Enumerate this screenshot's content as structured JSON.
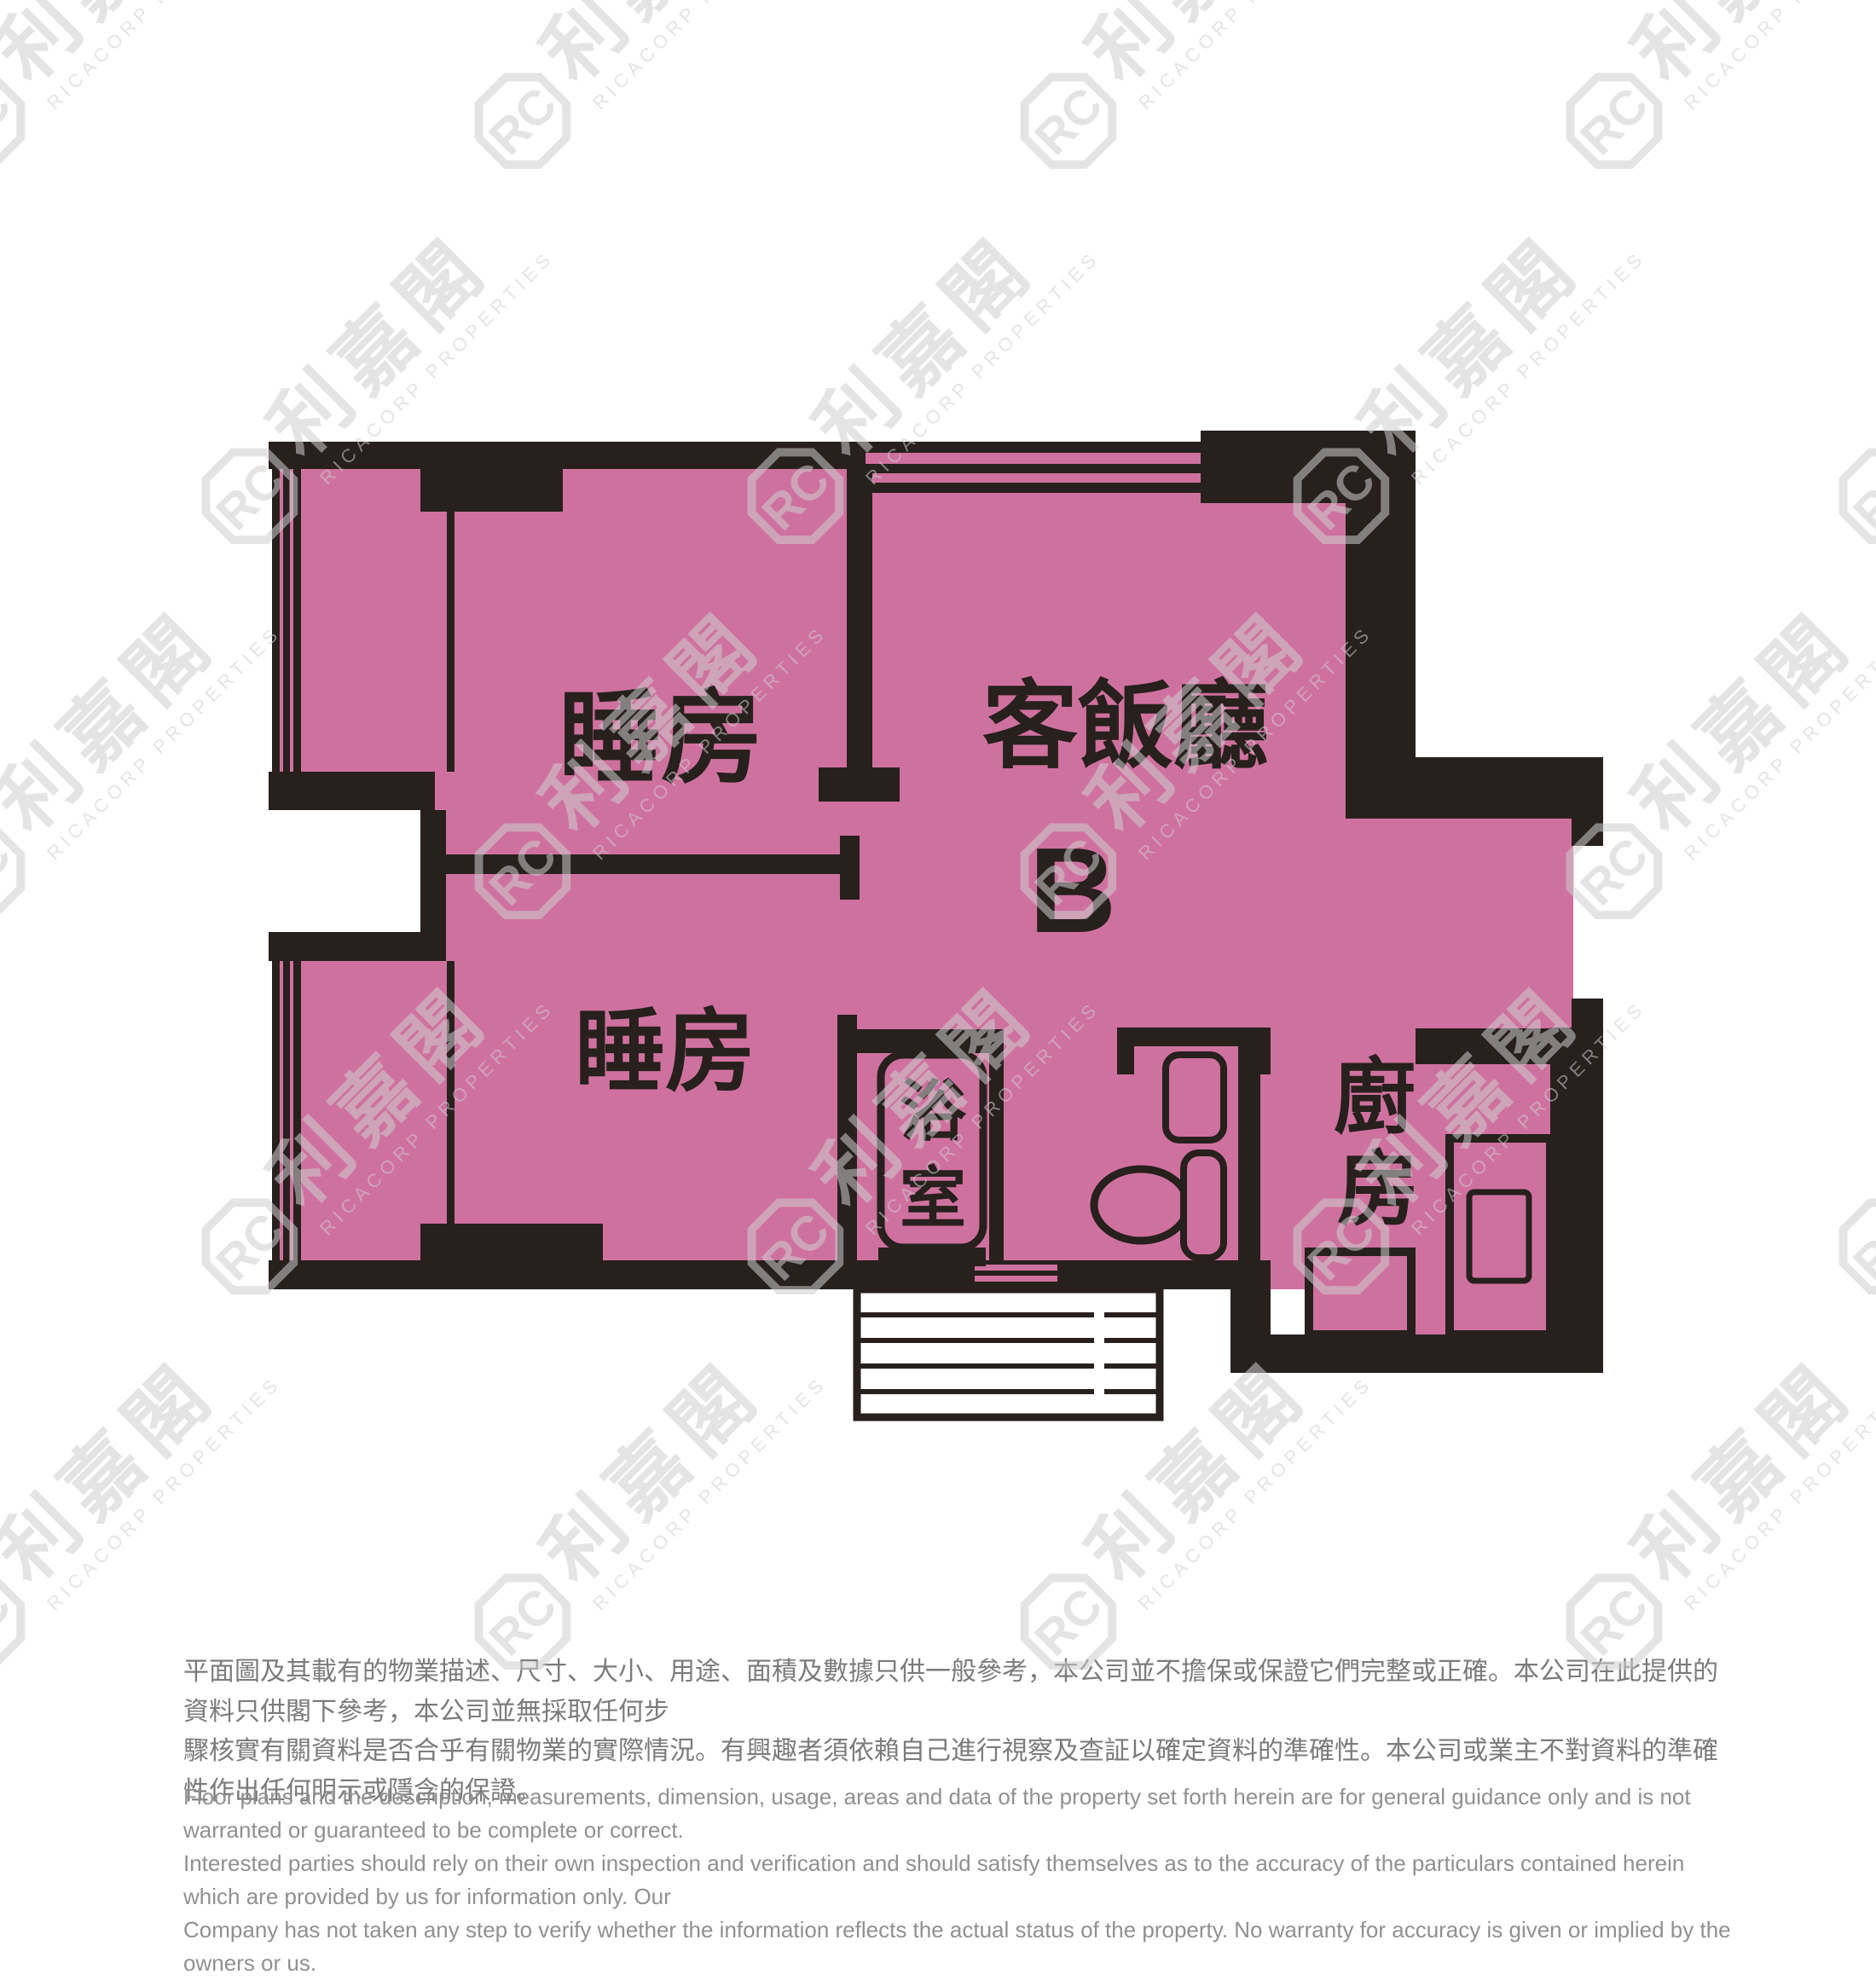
{
  "floor_plan": {
    "unit_label": "B",
    "rooms": {
      "bedroom1": "睡房",
      "bedroom2": "睡房",
      "living_dining": "客飯廳",
      "bathroom_chars": [
        "浴",
        "室"
      ],
      "kitchen_chars": [
        "廚",
        "房"
      ]
    },
    "colors": {
      "room_fill": "#cf719e",
      "wall": "#27201d",
      "outside": "#ffffff"
    }
  },
  "watermark": {
    "logo_letters": "RC",
    "chinese": "利嘉閣",
    "english": "RICACORP PROPERTIES"
  },
  "disclaimer": {
    "chinese_lines": [
      "平面圖及其載有的物業描述、尺寸、大小、用途、面積及數據只供一般參考，本公司並不擔保或保證它們完整或正確。本公司在此提供的資料只供閣下參考，本公司並無採取任何步",
      "驟核實有關資料是否合乎有關物業的實際情況。有興趣者須依賴自己進行視察及查証以確定資料的準確性。本公司或業主不對資料的準確性作出任何明示或隱含的保證。"
    ],
    "english_lines": [
      "Floor plans and the description, measurements, dimension, usage, areas and data of the property set forth herein are for general guidance only and is not warranted or guaranteed to be complete or correct.",
      "Interested parties should rely on their own inspection and verification and should satisfy themselves as to the accuracy of the particulars contained herein which are provided by us for information only.  Our",
      "Company has not taken any step to verify whether the information reflects the actual status of the property.  No warranty for accuracy is given or implied by the owners or us."
    ]
  }
}
